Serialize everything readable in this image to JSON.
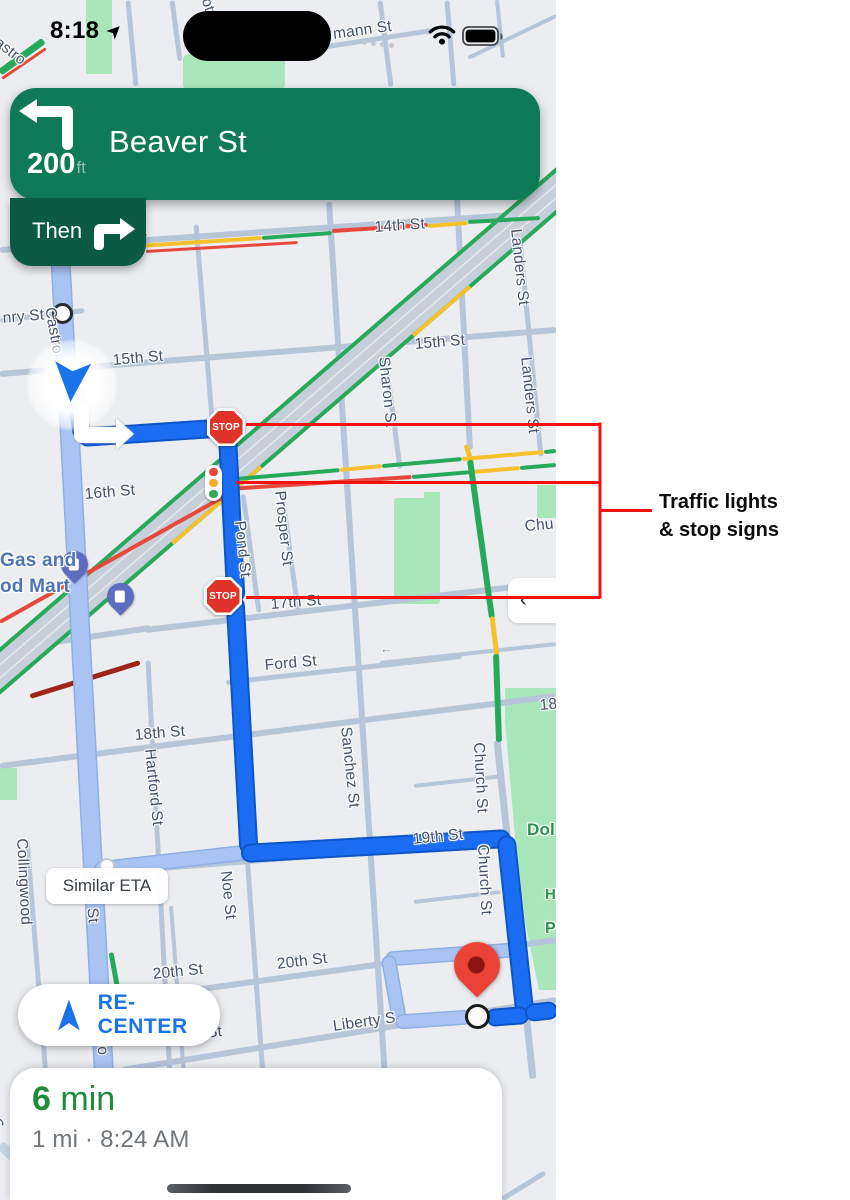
{
  "status_bar": {
    "time": "8:18"
  },
  "navigation": {
    "distance": "200",
    "distance_unit": "ft",
    "street": "Beaver St",
    "then_label": "Then"
  },
  "map": {
    "stop_sign_text": "STOP",
    "similar_eta_label": "Similar ETA",
    "recenter_label": "RE-CENTER",
    "panel_chevron": "‹",
    "labels": [
      {
        "t": "ott St",
        "x": 214,
        "y": -4,
        "r": 72,
        "s": 15
      },
      {
        "t": "mann St",
        "x": 332,
        "y": 26,
        "r": -8
      },
      {
        "t": "astro",
        "x": 2,
        "y": 34,
        "r": 38,
        "s": 15
      },
      {
        "t": "nry St",
        "x": 2,
        "y": 310,
        "r": -5
      },
      {
        "t": "Castro St",
        "x": 58,
        "y": 306,
        "r": 80
      },
      {
        "t": "15th St",
        "x": 112,
        "y": 352,
        "r": -5
      },
      {
        "t": "15th St",
        "x": 414,
        "y": 336,
        "r": -5
      },
      {
        "t": "14th St",
        "x": 96,
        "y": 226,
        "r": -4
      },
      {
        "t": "14th St",
        "x": 374,
        "y": 219,
        "r": -4
      },
      {
        "t": "Landers St",
        "x": 524,
        "y": 228,
        "r": 84
      },
      {
        "t": "Landers St",
        "x": 534,
        "y": 356,
        "r": 84
      },
      {
        "t": "Sharon St",
        "x": 392,
        "y": 356,
        "r": 84
      },
      {
        "t": "16th St",
        "x": 84,
        "y": 486,
        "r": -5
      },
      {
        "t": "Pond St",
        "x": 248,
        "y": 520,
        "r": 84
      },
      {
        "t": "Prosper St",
        "x": 288,
        "y": 490,
        "r": 84
      },
      {
        "t": "17th St",
        "x": 270,
        "y": 596,
        "r": -5
      },
      {
        "t": "Ford St",
        "x": 264,
        "y": 657,
        "r": -5
      },
      {
        "t": "18th St",
        "x": 134,
        "y": 727,
        "r": -5
      },
      {
        "t": "18",
        "x": 539,
        "y": 697,
        "r": -5
      },
      {
        "t": "Hartford St",
        "x": 158,
        "y": 748,
        "r": 84
      },
      {
        "t": "Sanchez St",
        "x": 354,
        "y": 726,
        "r": 84
      },
      {
        "t": "Church St",
        "x": 487,
        "y": 742,
        "r": 87
      },
      {
        "t": "Church St",
        "x": 491,
        "y": 844,
        "r": 87
      },
      {
        "t": "Chu",
        "x": 524,
        "y": 518,
        "r": -5
      },
      {
        "t": "19th St",
        "x": 412,
        "y": 831,
        "r": -6
      },
      {
        "t": "Noe St",
        "x": 234,
        "y": 870,
        "r": 84
      },
      {
        "t": "Collingwood",
        "x": 30,
        "y": 838,
        "r": 87
      },
      {
        "t": "stro St",
        "x": 97,
        "y": 876,
        "r": 84
      },
      {
        "t": "ro",
        "x": 110,
        "y": 1040,
        "r": 84
      },
      {
        "t": "20th St",
        "x": 152,
        "y": 966,
        "r": -6
      },
      {
        "t": "20th St",
        "x": 276,
        "y": 956,
        "r": -7
      },
      {
        "t": "Liberty St",
        "x": 154,
        "y": 1030,
        "r": -6
      },
      {
        "t": "Liberty S",
        "x": 332,
        "y": 1018,
        "r": -8
      },
      {
        "t": "t S",
        "x": -4,
        "y": 1108,
        "r": 55
      },
      {
        "t": "Gas and",
        "x": 0,
        "y": 550,
        "cls": "poi-blue",
        "s": 19
      },
      {
        "t": "od Mart",
        "x": 0,
        "y": 576,
        "cls": "poi-blue",
        "s": 19
      },
      {
        "t": "Dol",
        "x": 527,
        "y": 820,
        "cls": "poi-green",
        "s": 17
      },
      {
        "t": "H",
        "x": 545,
        "y": 886,
        "cls": "poi-green",
        "s": 15
      },
      {
        "t": "P",
        "x": 545,
        "y": 920,
        "cls": "poi-green",
        "s": 16
      },
      {
        "t": "←",
        "x": 380,
        "y": 641,
        "cls": "oneway",
        "s": 13
      }
    ]
  },
  "bottom_sheet": {
    "eta_number": "6",
    "eta_unit": " min",
    "details": "1 mi · 8:24 AM"
  },
  "annotation": {
    "line1": "Traffic lights",
    "line2": "& stop signs"
  },
  "colors": {
    "nav_banner_green": "#0f7a58",
    "then_chip_green": "#0b5b44",
    "route_blue": "#1a6df2",
    "alt_route_blue": "#a9c4f3",
    "annotation_red": "#f61111",
    "eta_green": "#1f8b3b",
    "recenter_blue": "#1a73e8",
    "stop_sign_red": "#df332a",
    "park_green": "#a9e7ba",
    "traffic_green": "#27a95c",
    "traffic_yellow": "#f6c12c",
    "traffic_red": "#e6483b"
  }
}
